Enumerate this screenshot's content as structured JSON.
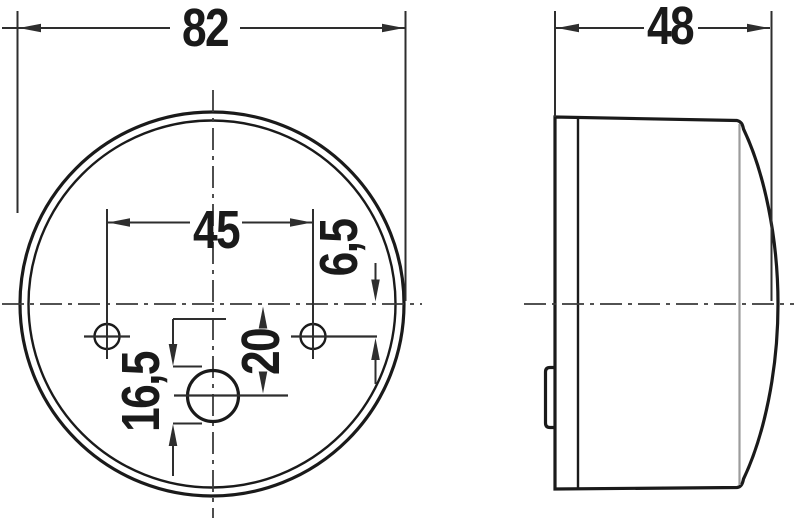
{
  "colors": {
    "background": "#ffffff",
    "ink": "#1a1a1a",
    "seat_line": "#9c9c9c"
  },
  "dimensions": {
    "front_diameter": "82",
    "side_depth": "48",
    "hole_spacing": "45",
    "hole_vertical_offset": "6,5",
    "center_hole_offset": "20",
    "lower_offset": "16,5"
  }
}
